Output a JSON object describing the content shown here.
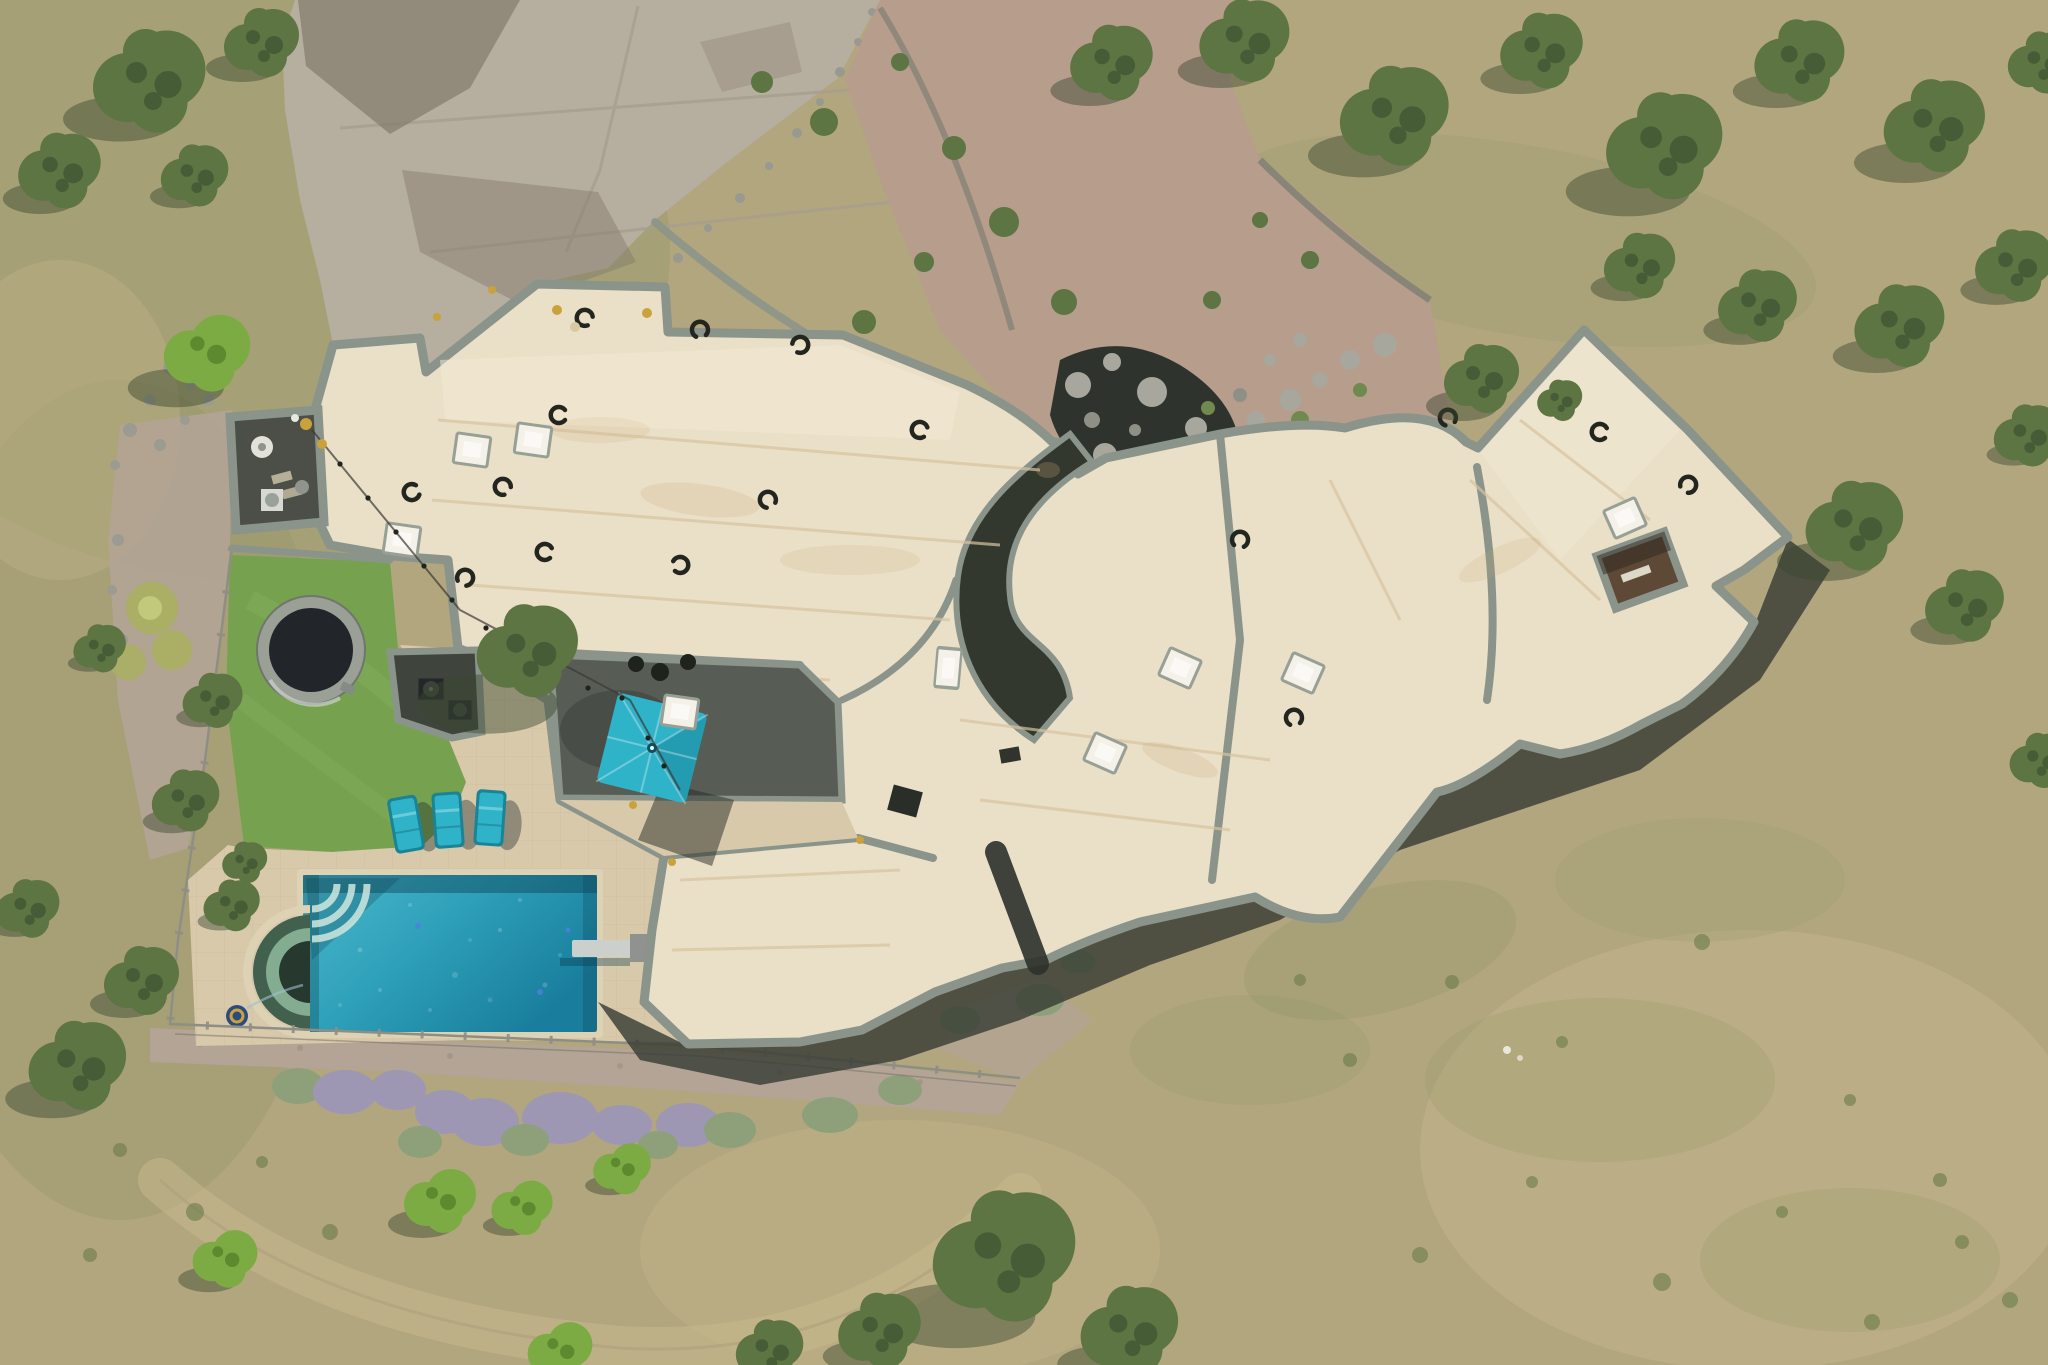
{
  "scene": {
    "type": "aerial-drone-photograph",
    "description": "Top-down aerial view of a modern single-story desert estate: flat cream membrane roofs with sage-gray parapets, turquoise rectangular swimming pool with semicircular green-tiered spa and diving board, three teal lounge chairs, one square teal patio umbrella, in-ground trampoline on bright artificial turf, concrete motor court, pink gravel planting beds, boulder-lined water feature, lavender hedge row, wire fence and dry scrub field with evergreen trees",
    "house": {
      "roof_color_name": "cream",
      "trim_color_name": "sage gray",
      "skylight_count": 9,
      "roof_vent_count": 16,
      "courtyards": [
        "entry courtyard with patio furniture",
        "equipment nook with AC units",
        "curved central courtyard",
        "right-wing inner courtyard"
      ],
      "rooftop_items": [
        "string-light cable with gold orbs",
        "gold parapet finials",
        "patio table"
      ]
    },
    "pool_area": {
      "pool_shape": "rectangle",
      "pool_features": [
        "corner entry steps",
        "diving board",
        "robotic pool cleaner"
      ],
      "spa_shape": "semicircle",
      "lounge_chair_count": 3,
      "umbrella_count": 1,
      "diving_board_count": 1,
      "trampoline_count": 1
    },
    "landscape": {
      "driveway": "poured concrete panels with expansion joints",
      "beds": "pink gravel with desert shrubs",
      "water_feature": "river-rock stream with gray boulders",
      "hedge": "lavender and sage bush row",
      "field": "dry tan grass with green scrub patches and a curved dirt track",
      "fence": "low wire fence with posts around the pool yard"
    }
  },
  "colors": {
    "field_base": "#b2a67f",
    "field_green": "#8b9465",
    "field_dark": "#6f7f4d",
    "field_tan": "#c9b98e",
    "roof_cream": "#eadfc7",
    "roof_panel": "#f3ebd8",
    "roof_seam": "#d6c3a0",
    "parapet_sage": "#8a948a",
    "shadow_dark": "#363b33",
    "court_dark": "#4b4f47",
    "patio_dark": "#575d55",
    "turf_green": "#76a24f",
    "turf_light": "#8cb562",
    "deck_tan": "#d8c9ab",
    "deck_line": "#c3b292",
    "driveway": "#b6ae9f",
    "driveway_joint": "#a79d8d",
    "driveway_shadow": "#837b6c",
    "gravel_pink": "#b79c8e",
    "gravel_path": "#b3a495",
    "pool_coping": "#ded2b4",
    "pool_light": "#4ab9cc",
    "pool_mid": "#2d9fb8",
    "pool_deep": "#197e9d",
    "spa_outer": "#41604e",
    "spa_mid": "#84ac90",
    "spa_core": "#27392e",
    "teal": "#2fb3c9",
    "teal_dark": "#1a8496",
    "tree_olive": "#5d7443",
    "tree_deep": "#465c36",
    "tree_bright": "#7cab43",
    "tree_shadow": "#39462f",
    "lavender": "#9d97b4",
    "sagebush": "#8da07a",
    "boulder": "#a7a79e",
    "stone_wall": "#7d7f73",
    "fence": "#8e8e85",
    "rust": "#a35d25",
    "gold": "#c9a23c",
    "water_dark": "#2e342d"
  }
}
